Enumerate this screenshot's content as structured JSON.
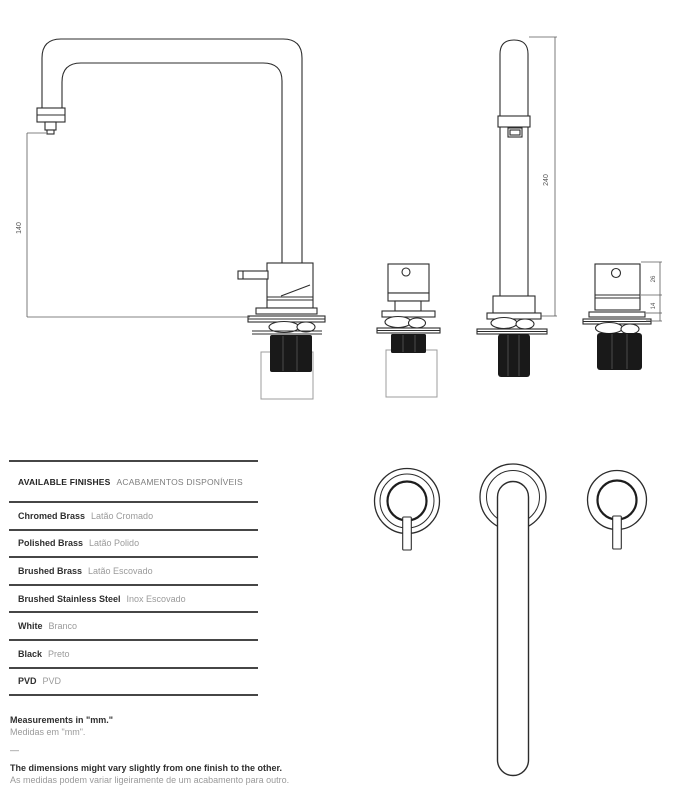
{
  "drawings": {
    "side_view": {
      "dim_height": "140"
    },
    "front_view": {
      "dim_height": "240"
    },
    "front_valve": {
      "dim_body": "26",
      "dim_neck": "14"
    }
  },
  "finishes": {
    "header": {
      "en": "AVAILABLE FINISHES",
      "pt": "ACABAMENTOS DISPONÍVEIS"
    },
    "rows": [
      {
        "en": "Chromed Brass",
        "pt": "Latão Cromado"
      },
      {
        "en": "Polished Brass",
        "pt": "Latão Polido"
      },
      {
        "en": "Brushed Brass",
        "pt": "Latão Escovado"
      },
      {
        "en": "Brushed Stainless Steel",
        "pt": "Inox Escovado"
      },
      {
        "en": "White",
        "pt": "Branco"
      },
      {
        "en": "Black",
        "pt": "Preto"
      },
      {
        "en": "PVD",
        "pt": "PVD"
      }
    ]
  },
  "notes": {
    "measurements_en": "Measurements in \"mm.\"",
    "measurements_pt": "Medidas em \"mm\".",
    "divider": "—",
    "tolerance_en": "The dimensions might vary slightly from one finish to the other.",
    "tolerance_pt": "As medidas podem variar ligeiramente de um acabamento para outro."
  },
  "colors": {
    "line": "#2c2c2c",
    "text_primary": "#2f2f2f",
    "text_secondary": "#9a9a9a",
    "dark_fill": "#191919"
  }
}
